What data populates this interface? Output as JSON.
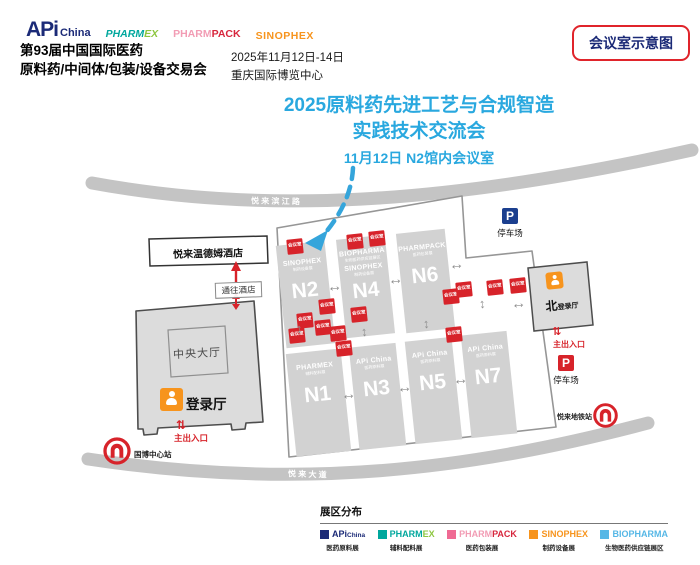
{
  "brands": {
    "api": {
      "a": "APi",
      "b": "China"
    },
    "pharmex": {
      "a": "PHARM",
      "b": "EX"
    },
    "pharmpack": {
      "a": "PHARM",
      "b": "PACK"
    },
    "sinophex": "SINOPHEX",
    "biopharma": "BIOPHARMA"
  },
  "header": {
    "title_line1": "第93届中国国际医药",
    "title_line2": "原料药/中间体/包装/设备交易会",
    "date": "2025年11月12日-14日",
    "venue": "重庆国际博览中心",
    "badge": "会议室示意图"
  },
  "announcement": {
    "line1": "2025原料药先进工艺与合规智造",
    "line2": "实践技术交流会",
    "line3": "11月12日  N2馆内会议室"
  },
  "map": {
    "road_top": "悦 来 滨 江 路",
    "road_bottom": "悦 来 大 道",
    "hotel": "悦来温德姆酒店",
    "to_hotel": "通往酒店",
    "central_hall": "中央大厅",
    "registration_hall": "登录厅",
    "north_hall_big": "北",
    "north_hall_small": "登录厅",
    "main_entrance": "主出入口",
    "parking": "停车场",
    "metro_station_left": "国博中心站",
    "metro_station_right": "悦来地铁站",
    "meeting_room": "会议室",
    "halls": {
      "n1": {
        "id": "N1",
        "brand": "PHARMEX",
        "sub": "辅料配料展"
      },
      "n2": {
        "id": "N2",
        "brand": "SINOPHEX",
        "sub": "制药设备展"
      },
      "n3": {
        "id": "N3",
        "brand": "APi China",
        "sub": "医药原料展"
      },
      "n4": {
        "id": "N4",
        "brand": "BIOPHARMA",
        "sub": "生物医药供应链展区",
        "brand2": "SINOPHEX",
        "sub2": "制药设备展"
      },
      "n5": {
        "id": "N5",
        "brand": "APi China",
        "sub": "医药原料展"
      },
      "n6": {
        "id": "N6",
        "brand": "PHARMPACK",
        "sub": "医药包装展"
      },
      "n7": {
        "id": "N7",
        "brand": "APi China",
        "sub": "医药原料展"
      }
    }
  },
  "legend": {
    "title": "展区分布",
    "descs": {
      "api": "医药原料展",
      "pharmex": "辅料配料展",
      "pharmpack": "医药包装展",
      "sinophex": "制药设备展",
      "biopharma": "生物医药供应链展区"
    }
  },
  "icons": {
    "parking": "P",
    "arrow_h": "↔",
    "arrow_v": "↕",
    "entrance": "⇅"
  },
  "colors": {
    "accent_blue": "#29A8DF",
    "brand_navy": "#1B2A77",
    "red": "#D7232A",
    "orange": "#F7941D"
  }
}
